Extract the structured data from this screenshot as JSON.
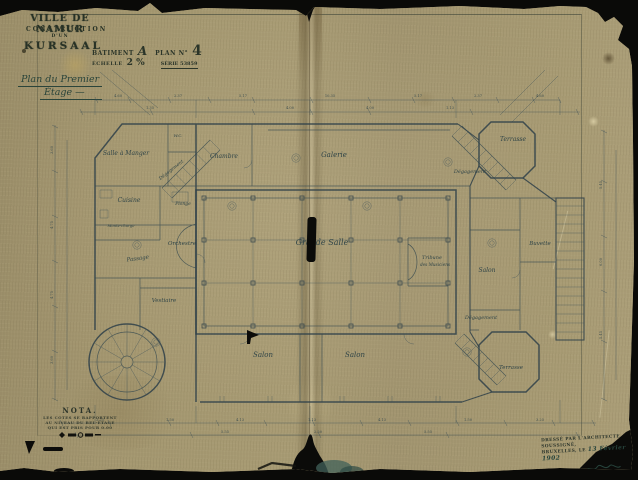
{
  "title_block": {
    "city_line": "VILLE DE NAMUR",
    "construction_line": "CONSTRUCTION",
    "dun_line": "D'UN",
    "kursaal_line": "KURSAAL",
    "stamp": {
      "batiment_label": "BATIMENT",
      "batiment_value": "A",
      "plan_label": "PLAN N°",
      "plan_value": "4",
      "echelle_label": "ÉCHELLE",
      "echelle_value": "2 %",
      "serie_line": "SÉRIE 53859"
    },
    "handwritten_title_line1": "Plan du Premier",
    "handwritten_title_line2": "Étage —"
  },
  "nota": {
    "title": "NOTA.",
    "line1": "LES COTES SE RAPPORTENT",
    "line2": "AU NIVEAU DU BEL-ÉTAGE",
    "line3": "QUI EST PRIS POUR 0.00"
  },
  "signature_block": {
    "line1": "DRESSÉ PAR L'ARCHITECTE",
    "line2": "SOUSSIGNÉ,",
    "line3": "BRUXELLES, LE",
    "date_handwritten": "13 Février 1902"
  },
  "colors": {
    "paper": "#a39670",
    "ink": "#2e4049",
    "stamp_ink": "#2b3529",
    "handwriting": "#2a443a"
  },
  "plan": {
    "rooms": [
      {
        "label": "Salle à Manger",
        "x": 126,
        "y": 155,
        "s": 6
      },
      {
        "label": "W.C.",
        "x": 178,
        "y": 137,
        "s": 4
      },
      {
        "label": "Chambre",
        "x": 224,
        "y": 158,
        "s": 6
      },
      {
        "label": "Galerie",
        "x": 334,
        "y": 157,
        "s": 7
      },
      {
        "label": "Terrasse",
        "x": 513,
        "y": 141,
        "s": 6
      },
      {
        "label": "Dégagement",
        "x": 172,
        "y": 171,
        "s": 4.6,
        "rot": -38
      },
      {
        "label": "Dégagement",
        "x": 470,
        "y": 173,
        "s": 5
      },
      {
        "label": "Cuisine",
        "x": 129,
        "y": 202,
        "s": 6
      },
      {
        "label": "Plonge",
        "x": 183,
        "y": 205,
        "s": 4.5
      },
      {
        "label": "Monte-charge",
        "x": 121,
        "y": 227,
        "s": 3.8
      },
      {
        "label": "Orchestre",
        "x": 182,
        "y": 245,
        "s": 5.5
      },
      {
        "label": "Passage",
        "x": 138,
        "y": 260,
        "s": 5.5,
        "rot": -8
      },
      {
        "label": "Grande Salle",
        "x": 322,
        "y": 245,
        "s": 8
      },
      {
        "label": "Tribune",
        "x": 432,
        "y": 259,
        "s": 5
      },
      {
        "label": "des Musiciens",
        "x": 435,
        "y": 266,
        "s": 4.2
      },
      {
        "label": "Vestiaire",
        "x": 164,
        "y": 302,
        "s": 5.5
      },
      {
        "label": "Salon",
        "x": 263,
        "y": 357,
        "s": 7
      },
      {
        "label": "Salon",
        "x": 355,
        "y": 357,
        "s": 7
      },
      {
        "label": "Salon",
        "x": 487,
        "y": 272,
        "s": 6
      },
      {
        "label": "Buvette",
        "x": 540,
        "y": 245,
        "s": 5.5
      },
      {
        "label": "Dégagement",
        "x": 481,
        "y": 319,
        "s": 5
      },
      {
        "label": "Terrasse",
        "x": 511,
        "y": 369,
        "s": 5.5
      }
    ],
    "dimensions": [
      {
        "label": "4.60",
        "x": 118,
        "y": 97
      },
      {
        "label": "2.37",
        "x": 178,
        "y": 97
      },
      {
        "label": "5.17",
        "x": 243,
        "y": 97
      },
      {
        "label": "10.35",
        "x": 330,
        "y": 97
      },
      {
        "label": "5.17",
        "x": 418,
        "y": 97
      },
      {
        "label": "2.37",
        "x": 478,
        "y": 97
      },
      {
        "label": "4.60",
        "x": 540,
        "y": 97
      },
      {
        "label": "1.35",
        "x": 150,
        "y": 109
      },
      {
        "label": "4.00",
        "x": 290,
        "y": 109
      },
      {
        "label": "4.00",
        "x": 370,
        "y": 109
      },
      {
        "label": "1.13",
        "x": 450,
        "y": 109
      },
      {
        "label": "3.25",
        "x": 100,
        "y": 421
      },
      {
        "label": "1.50",
        "x": 170,
        "y": 421
      },
      {
        "label": "4.13",
        "x": 240,
        "y": 421
      },
      {
        "label": "1.13",
        "x": 312,
        "y": 421
      },
      {
        "label": "4.13",
        "x": 382,
        "y": 421
      },
      {
        "label": "1.50",
        "x": 468,
        "y": 421
      },
      {
        "label": "3.25",
        "x": 540,
        "y": 421
      },
      {
        "label": "5.55",
        "x": 225,
        "y": 433
      },
      {
        "label": "2.50",
        "x": 318,
        "y": 433
      },
      {
        "label": "5.55",
        "x": 428,
        "y": 433
      },
      {
        "label": "3.60",
        "x": 53,
        "y": 150,
        "rot": -90
      },
      {
        "label": "4.75",
        "x": 53,
        "y": 225,
        "rot": -90
      },
      {
        "label": "4.75",
        "x": 53,
        "y": 295,
        "rot": -90
      },
      {
        "label": "3.60",
        "x": 53,
        "y": 360,
        "rot": -90
      },
      {
        "label": "5.45",
        "x": 602,
        "y": 185,
        "rot": -90
      },
      {
        "label": "6.00",
        "x": 602,
        "y": 262,
        "rot": -90
      },
      {
        "label": "5.45",
        "x": 602,
        "y": 335,
        "rot": -90
      }
    ]
  }
}
